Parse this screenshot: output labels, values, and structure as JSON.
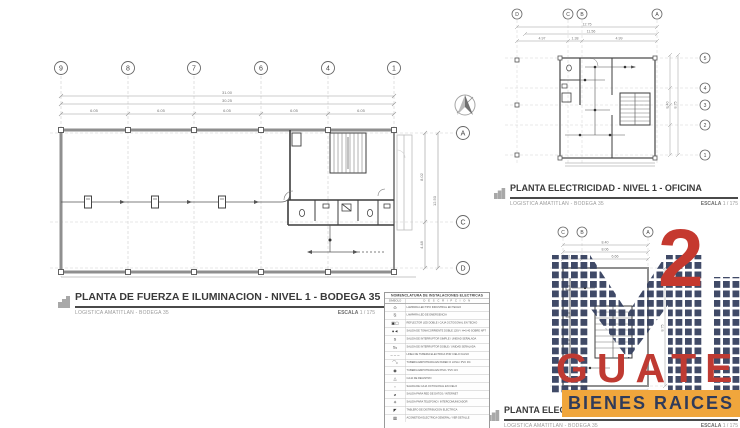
{
  "watermark": {
    "number": "2",
    "name": "GUATE",
    "tagline": "BIENES RAICES",
    "tile_color": "#36415f",
    "red": "#bf3a32",
    "yellow": "#f0a63c",
    "navy": "#2f3b5a"
  },
  "plans": {
    "bodega": {
      "title": "PLANTA DE FUERZA E ILUMINACION - NIVEL 1 - BODEGA 35",
      "subtitle": "LOGISTICA AMATITLAN - BODEGA 35",
      "scale_label": "ESCALA",
      "scale_value": "1 / 175",
      "grid_top": [
        "9",
        "8",
        "7",
        "6",
        "4",
        "1"
      ],
      "grid_right": [
        "A",
        "C",
        "D"
      ],
      "dims": {
        "total": "31.00",
        "inner": "30.25",
        "bays": [
          "6.05",
          "6.05",
          "6.05",
          "6.05",
          "6.05"
        ],
        "right_upper": "8.02",
        "right_total": "12.50",
        "right_lower": "4.48"
      }
    },
    "oficina": {
      "title": "PLANTA ELECTRICIDAD - NIVEL 1 - OFICINA",
      "subtitle": "LOGISTICA AMATITLAN - BODEGA 35",
      "scale_label": "ESCALA",
      "scale_value": "1 / 175",
      "grid_top": [
        "D",
        "C",
        "B",
        "A"
      ],
      "grid_right": [
        "5",
        "4",
        "3",
        "2",
        "1"
      ],
      "dims": {
        "total": "12.75",
        "inner": "11.56",
        "bays": [
          "4.97",
          "1.38",
          "4.99"
        ],
        "right_total": "8.75",
        "right_inner": "8.40"
      }
    },
    "nivel2": {
      "title_visible": "PLANTA ELECTR",
      "subtitle": "LOGISTICA AMATITLAN - BODEGA 35",
      "scale_label": "ESCALA",
      "scale_value": "1 / 175",
      "grid_top": [
        "C",
        "B",
        "A"
      ],
      "dims": {
        "total": "8.40",
        "inner": "8.06",
        "bays": [
          "1.35",
          "6.66"
        ],
        "right_total": "8.75"
      }
    }
  },
  "legend": {
    "title": "NOMENCLATURA DE INSTALACIONES ELECTRICAS",
    "col_symbol": "SIMBOLO",
    "col_desc": "D E S C R I P C I O N",
    "rows": [
      {
        "symbol": "⊙",
        "desc": "LAMPARA LED TIPO INDUSTRIAL EN TECHO"
      },
      {
        "symbol": "⍉",
        "desc": "LAMPARA LED DE EMERGENCIA"
      },
      {
        "symbol": "▣▢",
        "desc": "REFLECTOR LED DOBLE / CAJA OCTOGONAL EN TECHO"
      },
      {
        "symbol": "●◄",
        "desc": "SALIDA DE TOMACORRIENTE DOBLE 120V / H=0.40 SOBRE NPT"
      },
      {
        "symbol": "S",
        "desc": "SALIDA DE INTERRUPTOR SIMPLE / UNIDAD SEÑALADA"
      },
      {
        "symbol": "S₂",
        "desc": "SALIDA DE INTERRUPTOR DOBLE / UNIDAD SEÑALADA"
      },
      {
        "symbol": "– – –",
        "desc": "LINEA DE TUBERIA ELECTRICA POR CIELO FALSO"
      },
      {
        "symbol": "⌒•",
        "desc": "TUBERIA EMPOTRADA EN PARED O LOSA / PVC 3/4"
      },
      {
        "symbol": "◉",
        "desc": "TUBERIA EMPOTRADA EN PISO / PVC 3/4"
      },
      {
        "symbol": "△",
        "desc": "CAJA DE REGISTRO"
      },
      {
        "symbol": "▫",
        "desc": "SALIDA DE CAJA OCTOGONAL EN CIELO"
      },
      {
        "symbol": "⌀",
        "desc": "SALIDA PARA RED DE DATOS / INTERNET"
      },
      {
        "symbol": "✳",
        "desc": "SALIDA PARA TELEFONO / INTERCOMUNICADOR"
      },
      {
        "symbol": "◤",
        "desc": "TABLERO DE DISTRIBUCION ELECTRICA"
      },
      {
        "symbol": "▨",
        "desc": "ACOMETIDA ELECTRICA GENERAL / VER DETALLE"
      }
    ]
  }
}
